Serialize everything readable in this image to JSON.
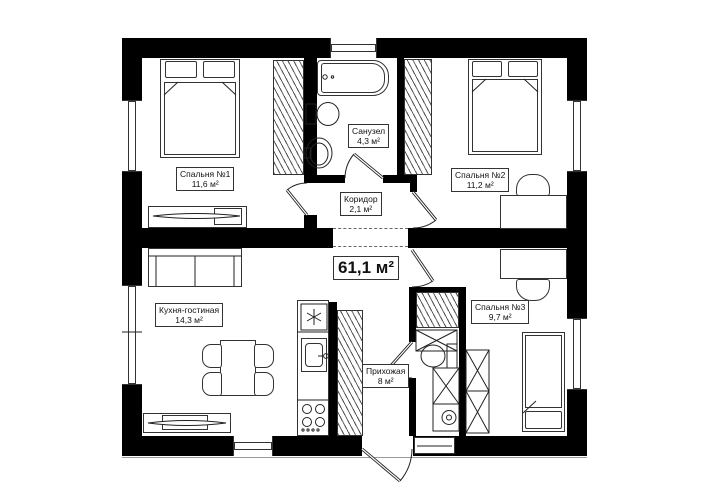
{
  "total_area": "61,1 м²",
  "rooms": [
    {
      "name": "Спальня №1",
      "area": "11,6 м²"
    },
    {
      "name": "Санузел",
      "area": "4,3 м²"
    },
    {
      "name": "Спальня №2",
      "area": "11,2 м²"
    },
    {
      "name": "Коридор",
      "area": "2,1 м²"
    },
    {
      "name": "Кухня-гостиная",
      "area": "14,3 м²"
    },
    {
      "name": "Прихожая",
      "area": "8 м²"
    },
    {
      "name": "Спальня №3",
      "area": "9,7 м²"
    }
  ]
}
